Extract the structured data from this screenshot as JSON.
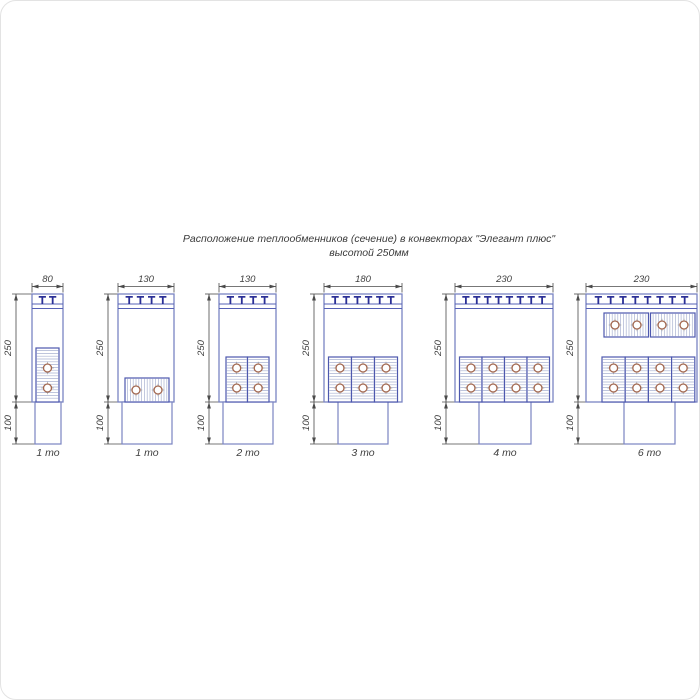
{
  "title": {
    "line1": "Расположение теплообменников (сечение) в конвекторах \"Элегант плюс\"",
    "line2": "высотой 250мм"
  },
  "colors": {
    "outline_blue": "#7a84c2",
    "grille_blue": "#5560b5",
    "tee_navy": "#2a2f96",
    "block_border": "#4d58ae",
    "fin_line": "#a9b2d0",
    "tube_stroke": "#a2674f",
    "tube_cross": "#8f8f8f",
    "dim_line": "#4a4a4a",
    "dim_text": "#3f3f3f",
    "title_text": "#3a3a3a"
  },
  "drawing": {
    "common": {
      "height_label": "250",
      "base_label": "100"
    },
    "diagrams": [
      {
        "label": "1 то",
        "width_label": "80",
        "height_label": "250",
        "base_label": "100",
        "tee_count": 2,
        "layout": {
          "mainX": 31,
          "mainW": 31,
          "lowerX": 34,
          "lowerW": 26,
          "dimX": 15
        },
        "blocks": [
          {
            "x": 35,
            "y": 347,
            "w": 23,
            "h": 54,
            "fins": "h",
            "tubes": [
              [
                46.5,
                367
              ],
              [
                46.5,
                387
              ]
            ]
          }
        ]
      },
      {
        "label": "1 то",
        "width_label": "130",
        "height_label": "250",
        "base_label": "100",
        "tee_count": 4,
        "layout": {
          "mainX": 117,
          "mainW": 56,
          "lowerX": 121,
          "lowerW": 50,
          "dimX": 107
        },
        "blocks": [
          {
            "x": 124,
            "y": 377,
            "w": 44,
            "h": 24,
            "fins": "v",
            "tubes": [
              [
                135,
                389
              ],
              [
                157,
                389
              ]
            ]
          }
        ]
      },
      {
        "label": "2 то",
        "width_label": "130",
        "height_label": "250",
        "base_label": "100",
        "tee_count": 4,
        "layout": {
          "mainX": 218,
          "mainW": 57,
          "lowerX": 222,
          "lowerW": 50,
          "dimX": 208
        },
        "blocks": [
          {
            "x": 225,
            "y": 356,
            "w": 21.5,
            "h": 45,
            "fins": "h",
            "tubes": [
              [
                235.7,
                367
              ],
              [
                235.7,
                387
              ]
            ]
          },
          {
            "x": 246.5,
            "y": 356,
            "w": 21.5,
            "h": 45,
            "fins": "h",
            "tubes": [
              [
                257.2,
                367
              ],
              [
                257.2,
                387
              ]
            ]
          }
        ]
      },
      {
        "label": "3 то",
        "width_label": "180",
        "height_label": "250",
        "base_label": "100",
        "tee_count": 6,
        "layout": {
          "mainX": 323,
          "mainW": 78,
          "lowerX": 337,
          "lowerW": 50,
          "dimX": 313
        },
        "blocks": [
          {
            "x": 327.5,
            "y": 356,
            "w": 23,
            "h": 45,
            "fins": "h",
            "tubes": [
              [
                339,
                367
              ],
              [
                339,
                387
              ]
            ]
          },
          {
            "x": 350.5,
            "y": 356,
            "w": 23,
            "h": 45,
            "fins": "h",
            "tubes": [
              [
                362,
                367
              ],
              [
                362,
                387
              ]
            ]
          },
          {
            "x": 373.5,
            "y": 356,
            "w": 23,
            "h": 45,
            "fins": "h",
            "tubes": [
              [
                385,
                367
              ],
              [
                385,
                387
              ]
            ]
          }
        ]
      },
      {
        "label": "4 то",
        "width_label": "230",
        "height_label": "250",
        "base_label": "100",
        "tee_count": 8,
        "layout": {
          "mainX": 454,
          "mainW": 98,
          "lowerX": 478,
          "lowerW": 52,
          "dimX": 445
        },
        "blocks": [
          {
            "x": 458.5,
            "y": 356,
            "w": 22.5,
            "h": 45,
            "fins": "h",
            "tubes": [
              [
                470,
                367
              ],
              [
                470,
                387
              ]
            ]
          },
          {
            "x": 481,
            "y": 356,
            "w": 22.5,
            "h": 45,
            "fins": "h",
            "tubes": [
              [
                492,
                367
              ],
              [
                492,
                387
              ]
            ]
          },
          {
            "x": 503.5,
            "y": 356,
            "w": 22.5,
            "h": 45,
            "fins": "h",
            "tubes": [
              [
                515,
                367
              ],
              [
                515,
                387
              ]
            ]
          },
          {
            "x": 526,
            "y": 356,
            "w": 22.5,
            "h": 45,
            "fins": "h",
            "tubes": [
              [
                537,
                367
              ],
              [
                537,
                387
              ]
            ]
          }
        ]
      },
      {
        "label": "6 то",
        "width_label": "230",
        "height_label": "250",
        "base_label": "100",
        "tee_count": 8,
        "layout": {
          "mainX": 585,
          "mainW": 111,
          "lowerX": 623,
          "lowerW": 51,
          "dimX": 577
        },
        "blocks": [
          {
            "x": 603,
            "y": 312,
            "w": 44.5,
            "h": 24,
            "fins": "v",
            "tubes": [
              [
                614,
                324
              ],
              [
                636,
                324
              ]
            ]
          },
          {
            "x": 649.5,
            "y": 312,
            "w": 44.5,
            "h": 24,
            "fins": "v",
            "tubes": [
              [
                661,
                324
              ],
              [
                683,
                324
              ]
            ]
          },
          {
            "x": 601,
            "y": 356,
            "w": 23.2,
            "h": 45,
            "fins": "h",
            "tubes": [
              [
                612.6,
                367
              ],
              [
                612.6,
                387
              ]
            ]
          },
          {
            "x": 624.2,
            "y": 356,
            "w": 23.2,
            "h": 45,
            "fins": "h",
            "tubes": [
              [
                635.8,
                367
              ],
              [
                635.8,
                387
              ]
            ]
          },
          {
            "x": 647.4,
            "y": 356,
            "w": 23.2,
            "h": 45,
            "fins": "h",
            "tubes": [
              [
                659,
                367
              ],
              [
                659,
                387
              ]
            ]
          },
          {
            "x": 670.6,
            "y": 356,
            "w": 23.2,
            "h": 45,
            "fins": "h",
            "tubes": [
              [
                682.2,
                367
              ],
              [
                682.2,
                387
              ]
            ]
          }
        ]
      }
    ]
  }
}
